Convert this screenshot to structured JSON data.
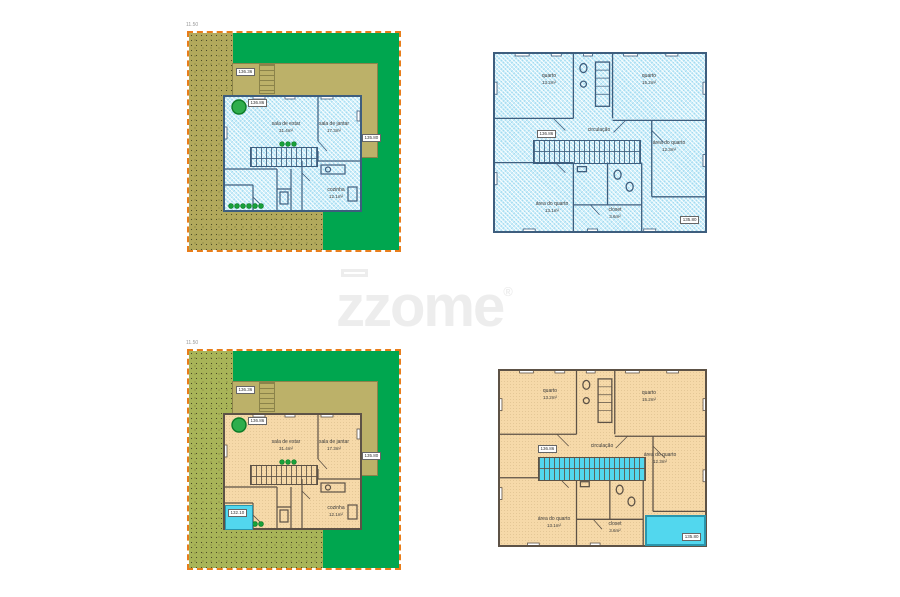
{
  "watermark": {
    "text": "zzome",
    "registered": "®"
  },
  "site_plan": {
    "dimension_top": "11.50",
    "rooms": {
      "living": {
        "name": "sala de estar",
        "area": "31.4m²"
      },
      "dining": {
        "name": "sala de jantar",
        "area": "17.3m²"
      },
      "kitchen": {
        "name": "cozinha",
        "area": "12.1m²"
      }
    },
    "levels": {
      "interior": "136.86",
      "deck": "136.36",
      "yard": "135.80",
      "pool": "132.10"
    }
  },
  "upper_plan": {
    "rooms": {
      "bedroom_left": {
        "name": "quarto",
        "area": "13.2m²"
      },
      "bedroom_right": {
        "name": "quarto",
        "area": "15.2m²"
      },
      "hall": {
        "name": "circulação"
      },
      "suite_area_right": {
        "name": "área do quarto",
        "area": "12.3m²"
      },
      "suite_area_left": {
        "name": "área do quarto",
        "area": "13.1m²"
      },
      "closet": {
        "name": "closet",
        "area": "3.6m²"
      }
    },
    "levels": {
      "hall": "136.86",
      "terrace": "135.80"
    }
  },
  "colors": {
    "lawn_green": "#00a64f",
    "terrain_olive": "#b2a95c",
    "boundary_orange": "#e87d1a",
    "plan_blue": "#cdeffa",
    "plan_orange": "#f6d9a9",
    "water_cyan": "#52d7ee"
  }
}
